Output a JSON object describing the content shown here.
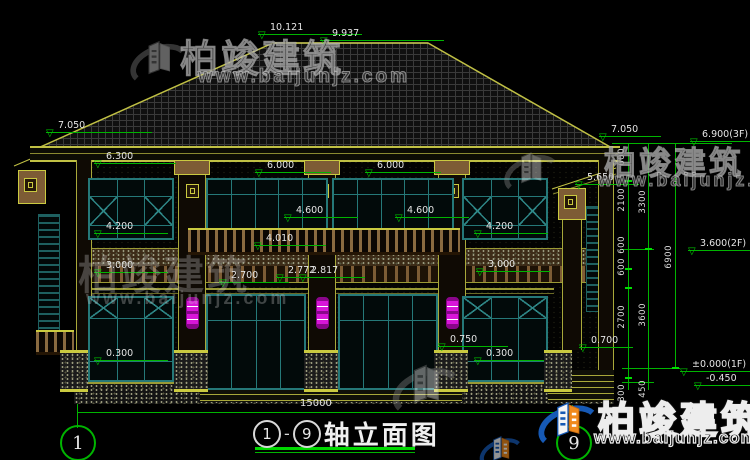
{
  "watermark": {
    "brand": "柏竣建筑",
    "url": "www.baijunjz.com"
  },
  "title": {
    "axis_start": "1",
    "sep": "-",
    "axis_end": "9",
    "label": "轴立面图"
  },
  "axis_bubbles": {
    "left": "1",
    "right": "9"
  },
  "dimensions": {
    "total_width": "15000"
  },
  "levels": {
    "ridge": "10.121",
    "ridge_lower": "9.937",
    "eave_left": "7.050",
    "eave_right": "7.050",
    "ceiling_2f": "6.300",
    "win_head_2f_a": "6.000",
    "win_head_2f_b": "6.000",
    "porch_right": "5.650",
    "door_head_2f_a": "4.600",
    "door_head_2f_b": "4.600",
    "sill_2f_a": "4.200",
    "sill_2f_b": "4.200",
    "rail_top": "4.010",
    "ceiling_1f_a": "3.000",
    "ceiling_1f_b": "3.000",
    "door_head_1f": "2.700",
    "head_1f_a": "2.772",
    "head_1f_b": "2.817",
    "porch_slab_a": "0.300",
    "platform": "0.750",
    "porch_slab_b": "0.300",
    "porch_slab_c": "0.700",
    "floor_3f": "6.900(3F)",
    "floor_2f": "3.600(2F)",
    "floor_1f": "±0.000(1F)",
    "ground": "-0.450"
  },
  "chain": {
    "a600": "600",
    "a2100": "2100",
    "b600": "600",
    "c600": "600",
    "a2700": "2700",
    "a300": "300",
    "a3300": "3300",
    "a3600": "3600",
    "a450": "450",
    "a6900": "6900"
  }
}
